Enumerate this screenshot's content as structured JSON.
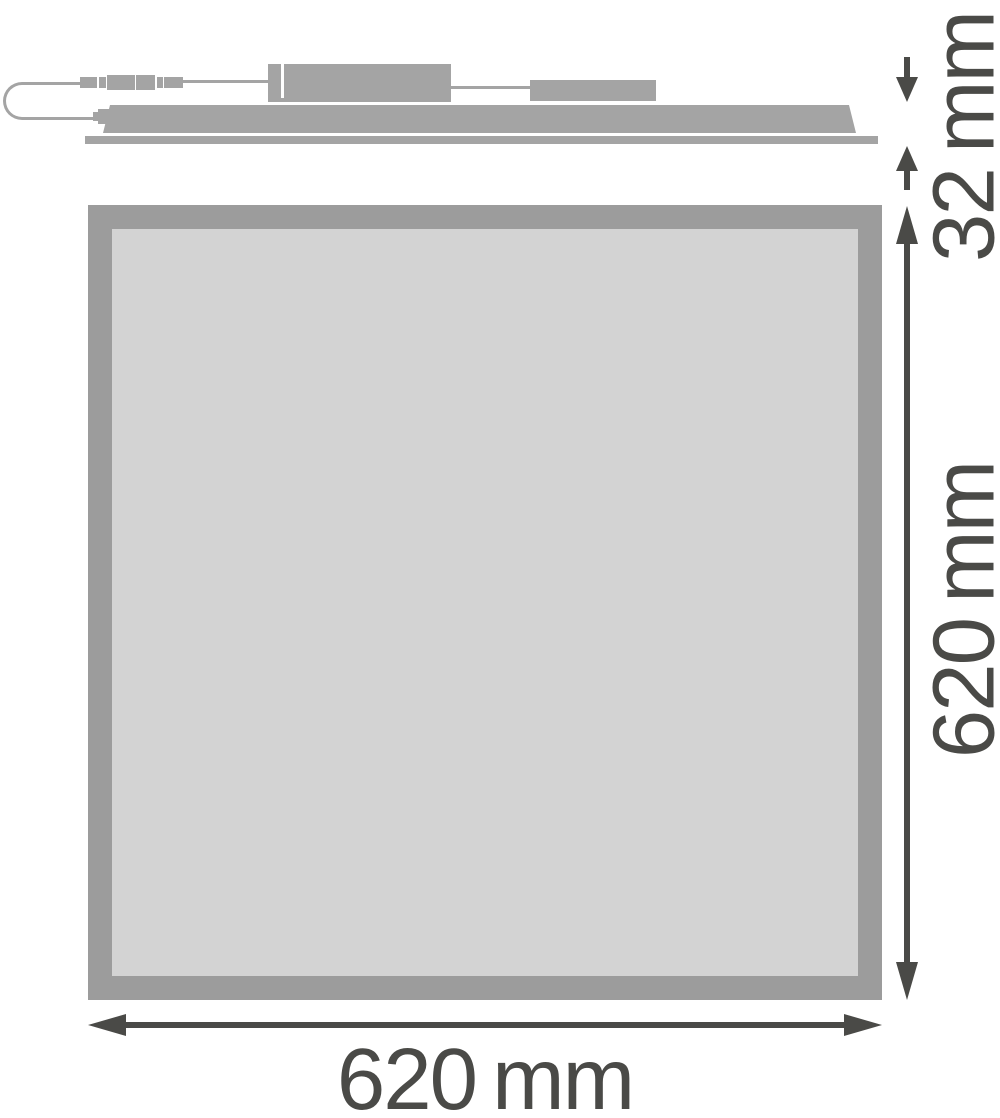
{
  "colors": {
    "side_gray": "#a4a4a4",
    "frame_gray": "#9c9c9c",
    "face_gray": "#d3d3d3",
    "dim_dark": "#4a4a47",
    "bg": "#ffffff"
  },
  "figure": {
    "description": "Technical dimension drawing of a square LED flat panel luminaire: side profile view on top with power cable, inline connector and driver boxes; square front view below",
    "dimensions": {
      "depth_label": "32 mm",
      "height_label": "620 mm",
      "width_label": "620 mm"
    }
  }
}
